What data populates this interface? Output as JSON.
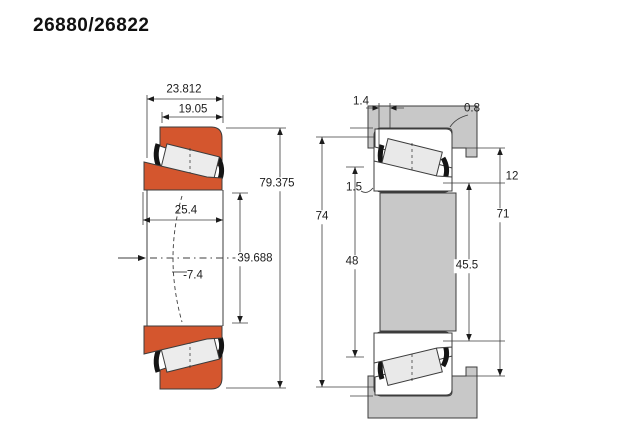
{
  "title": "26880/26822",
  "colors": {
    "ring_orange": "#d4562e",
    "steel_gray": "#c8c8c8",
    "roller_fill": "#ececec",
    "line": "#3c3c3c"
  },
  "left_view": {
    "dims": {
      "overall_width": "23.812",
      "cup_width": "19.05",
      "outer_diameter": "79.375",
      "cone_width": "25.4",
      "bore_diameter": "39.688",
      "load_center": "-7.4"
    }
  },
  "right_view": {
    "dims": {
      "gap_width": "1.4",
      "housing_fillet_radius": "0.8",
      "shaft_fillet_radius": "1.5",
      "housing_bore_width": "74",
      "shaft_shoulder_diameter": "48",
      "abutment_diameter": "45.5",
      "housing_shoulder_diameter": "71",
      "shoulder_offset": "12"
    }
  }
}
